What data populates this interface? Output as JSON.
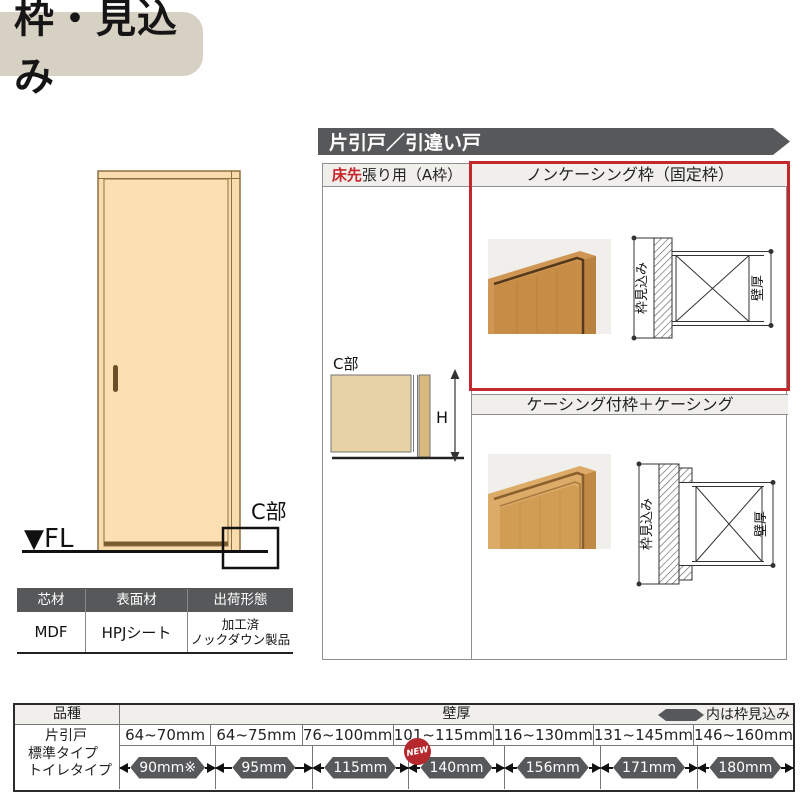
{
  "title": "枠・見込み",
  "banner": "片引戸／引違い戸",
  "door_fig": {
    "fl": "▼FL",
    "c_part": "C部"
  },
  "frame_table": {
    "col_a": {
      "red": "床先",
      "rest": "張り用（A枠）"
    },
    "c_part": "C部",
    "h": "H",
    "noncasing": {
      "title": "ノンケーシング枠（固定枠）",
      "dim_depth": "枠見込み",
      "dim_wall": "壁厚"
    },
    "casing": {
      "title": "ケーシング付枠＋ケーシング",
      "dim_depth": "枠見込み",
      "dim_wall": "壁厚"
    }
  },
  "material_table": {
    "headers": [
      "芯材",
      "表面材",
      "出荷形態"
    ],
    "values": [
      "MDF",
      "HPJシート",
      "加工済\nノックダウン製品"
    ]
  },
  "spec_table": {
    "product": "品種",
    "wall": "壁厚",
    "legend": "内は枠見込み",
    "products": [
      "片引戸",
      "標準タイプ",
      "トイレタイプ"
    ],
    "ranges": [
      "64~70mm",
      "64~75mm",
      "76~100mm",
      "101~115mm",
      "116~130mm",
      "131~145mm",
      "146~160mm"
    ],
    "depths": [
      "90mm※",
      "95mm",
      "115mm",
      "140mm",
      "156mm",
      "171mm",
      "180mm"
    ],
    "new": "NEW"
  },
  "colors": {
    "accent_red": "#c5282c",
    "dark_gray": "#57585a",
    "title_beige": "#d7d1c3",
    "door_tan": "#fcdfb2"
  }
}
